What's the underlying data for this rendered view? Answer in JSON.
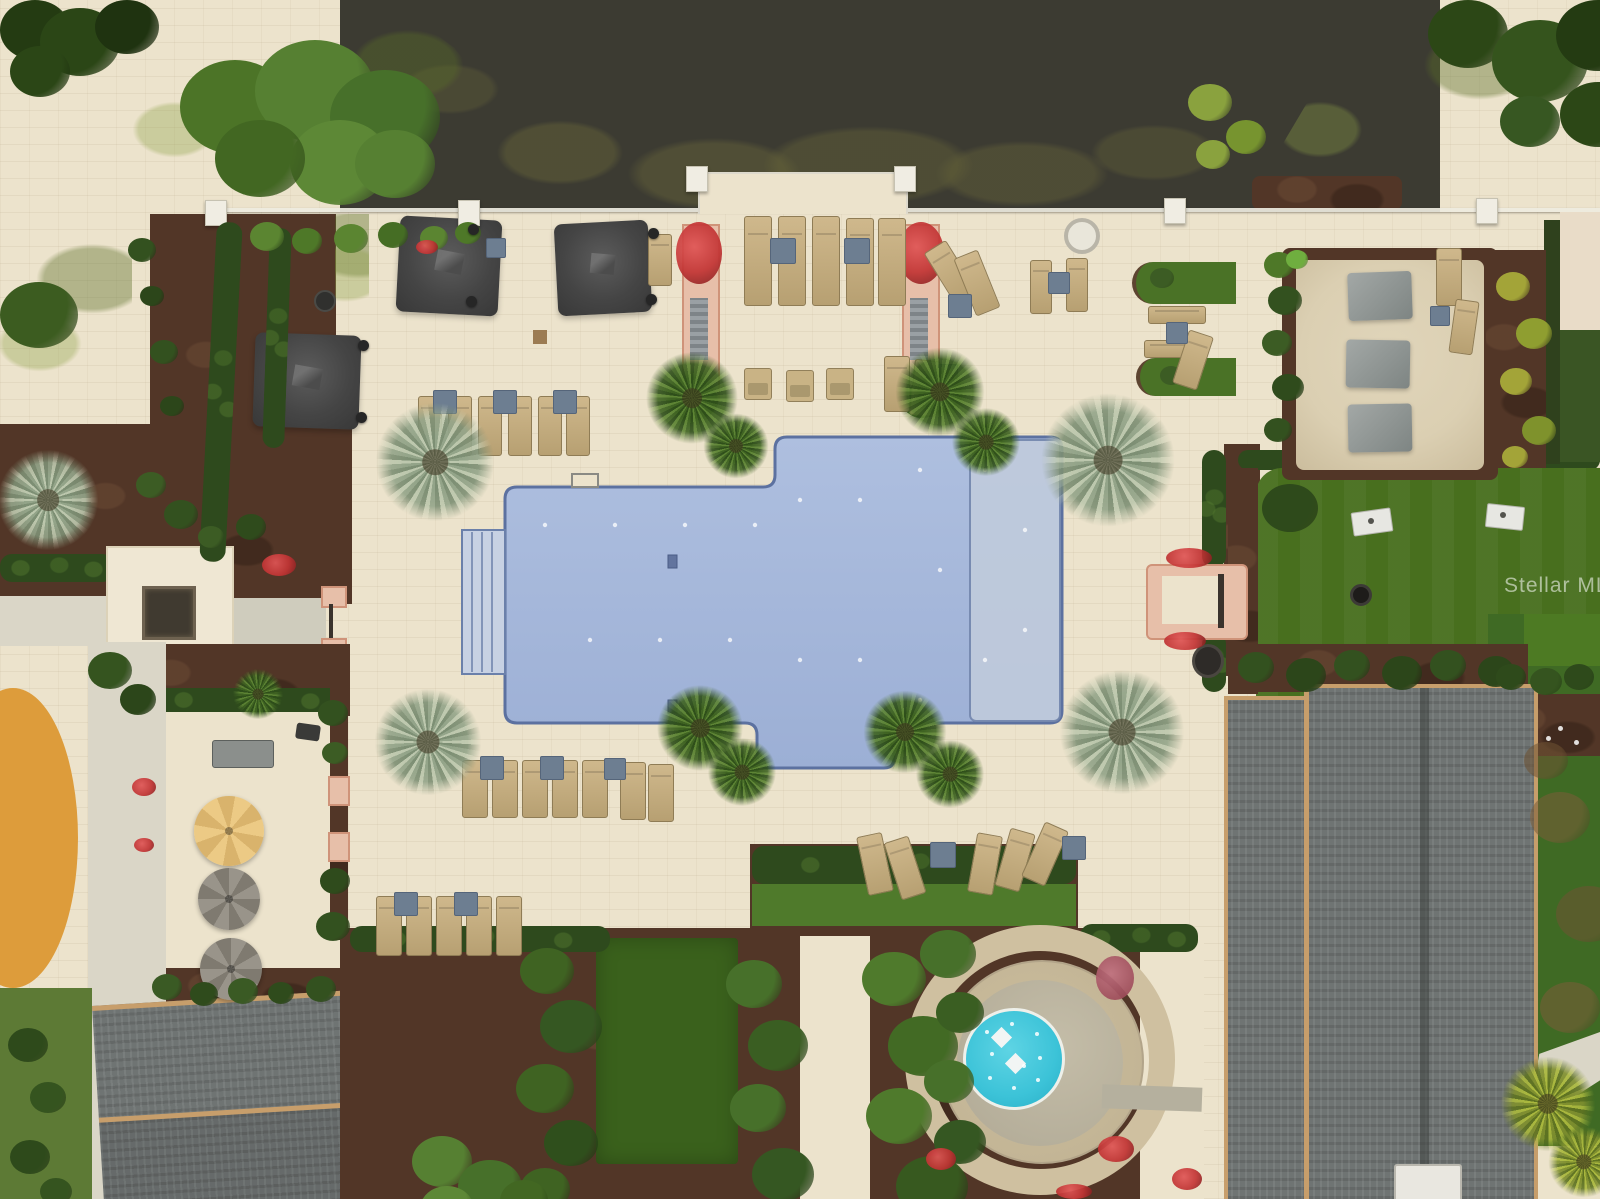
{
  "scene": {
    "type": "aerial-photograph",
    "description": "Top-down drone photograph of a resort-style community amenity center: cross-shaped blue swimming pool with sun shelf and entry steps on a cream paver deck, rows of tan lounge chairs with slate side tables, dark square cabanas, round patio umbrellas beside a grill station, a circular splash pad with turquoise wading pool, a sand hammock court with gray shade sails, an artificial-turf cornhole lawn with two boards, gray shingled clubhouse roofs, an orange playground surface edge, sidewalks, hedges, mulch beds, palm trees, and a dark pond with grassy banks across the top.",
    "watermark": {
      "text": "Stellar MLS",
      "color": "#ffffff",
      "opacity": 0.55
    }
  },
  "palette": {
    "deck": "#ece3cc",
    "pond": "#3c3b32",
    "pool": "#a6b7da",
    "poolShelf": "#c0cbdc",
    "poolEdge": "#5c71a0",
    "splash": "#3cc3d8",
    "turf": "#486f1e",
    "turfDark": "#3a611c",
    "grass": "#6f8d3e",
    "mulch": "#523627",
    "hedge": "#2e4a1d",
    "roof": "#6f7473",
    "trim": "#c79e6b",
    "lounger": "#c4ad80",
    "slate": "#6d7e91",
    "umbDark": "#474747",
    "umbTan": "#e5c37e",
    "umbGray": "#8e897e",
    "orange": "#dd9c3b",
    "sand": "#dbcfb2",
    "walk": "#dad6c7",
    "salmon": "#e7bfa9",
    "flower": "#c23434"
  },
  "features": [
    "pond",
    "pool",
    "pool-sun-shelf",
    "pool-steps",
    "pool-deck",
    "splash-pad",
    "cornhole-lawn",
    "sand-hammock-court",
    "clubhouse-roof",
    "left-building-roof",
    "bbq-patio",
    "memorial-plaza",
    "playground-edge",
    "lounge-chairs",
    "cabanas",
    "patio-umbrellas",
    "palm-trees",
    "hedges",
    "watermark"
  ]
}
